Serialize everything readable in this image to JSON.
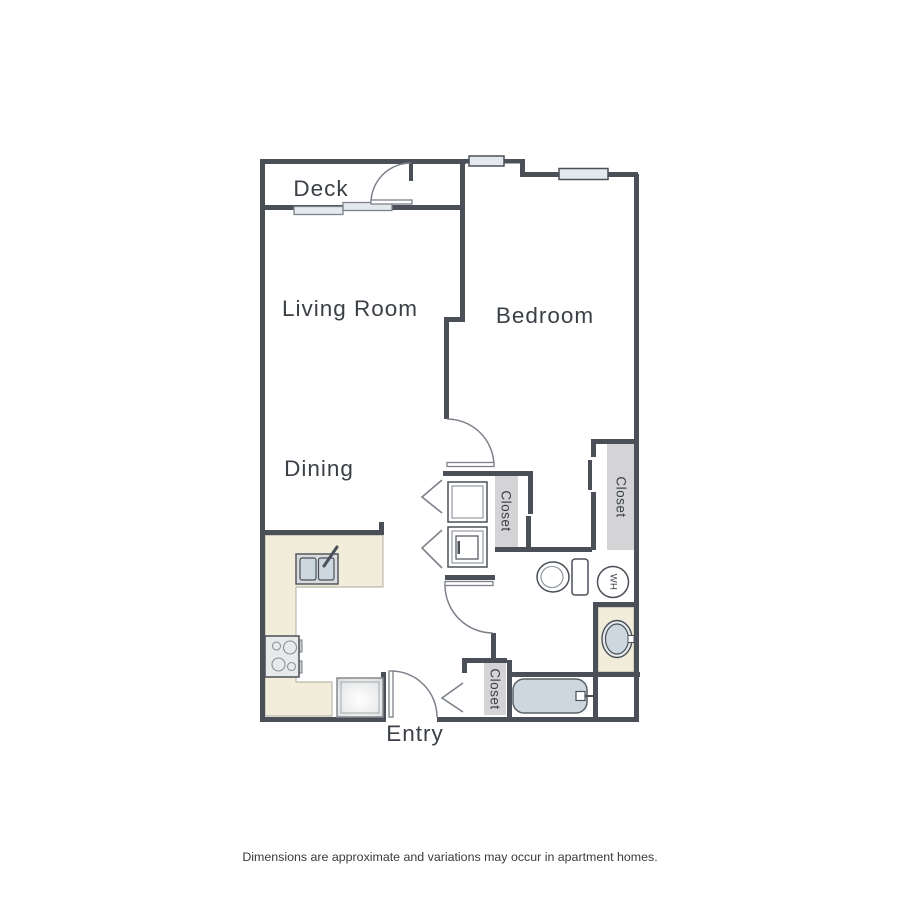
{
  "floorplan": {
    "rooms": {
      "deck": "Deck",
      "living_room": "Living Room",
      "bedroom": "Bedroom",
      "dining": "Dining",
      "entry": "Entry"
    },
    "closets": {
      "hall": "Closet",
      "bedroom": "Closet",
      "entry": "Closet"
    },
    "fixtures": {
      "water_heater": "WH"
    },
    "disclaimer": "Dimensions are approximate and variations may occur in apartment homes.",
    "colors": {
      "wall": "#4b5058",
      "line": "#7d828a",
      "window_fill": "#e3e9ed",
      "closet_fill": "#d4d4d6",
      "counter_fill": "#f1edda",
      "fixture_fill": "#ccd7df",
      "appliance_fill": "#e8e9ea",
      "text": "#3b4047"
    }
  }
}
